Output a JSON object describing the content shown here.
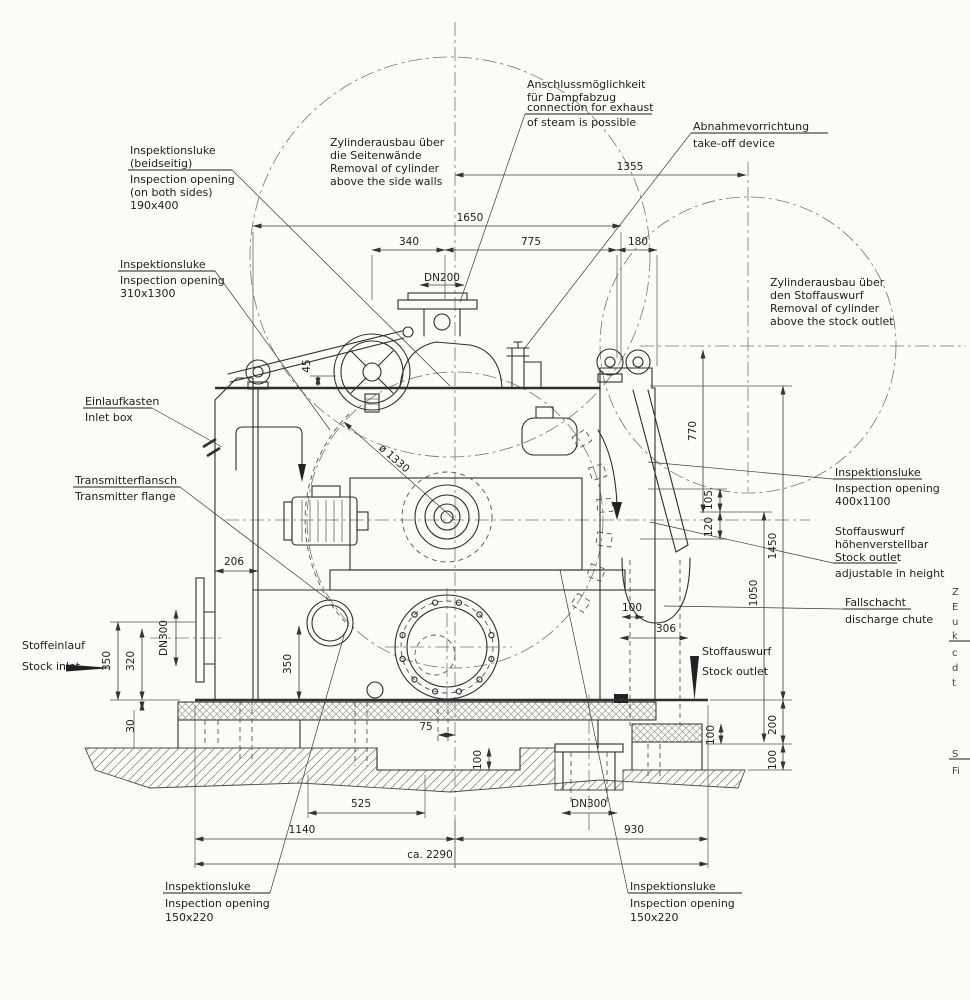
{
  "notes": {
    "steam": {
      "l1": "Anschlussmöglichkeit",
      "l2": "für Dampfabzug",
      "l3": "connection for exhaust",
      "l4": "of steam is possible"
    },
    "cyl_side": {
      "l1": "Zylinderausbau über",
      "l2": "die Seitenwände",
      "l3": "Removal of cylinder",
      "l4": "above the side walls"
    },
    "takeoff": {
      "l1": "Abnahmevorrichtung",
      "l2": "take-off device"
    },
    "insp190": {
      "l1": "Inspektionsluke",
      "l2": "(beidseitig)",
      "l3": "Inspection opening",
      "l4": "(on both sides)",
      "l5": "190x400"
    },
    "insp310": {
      "l1": "Inspektionsluke",
      "l2": "Inspection opening",
      "l3": "310x1300"
    },
    "cyl_outlet": {
      "l1": "Zylinderausbau über",
      "l2": "den Stoffauswurf",
      "l3": "Removal of cylinder",
      "l4": "above the stock outlet"
    },
    "inlet_box": {
      "l1": "Einlaufkasten",
      "l2": "Inlet box"
    },
    "transmitter": {
      "l1": "Transmitterflansch",
      "l2": "Transmitter flange"
    },
    "stock_inlet": {
      "l1": "Stoffeinlauf",
      "l2": "Stock inlet"
    },
    "insp400": {
      "l1": "Inspektionsluke",
      "l2": "Inspection opening",
      "l3": "400x1100"
    },
    "outlet_adj": {
      "l1": "Stoffauswurf",
      "l2": "höhenverstellbar",
      "l3": "Stock outlet",
      "l4": "adjustable in height"
    },
    "fallschacht": {
      "l1": "Fallschacht",
      "l2": "discharge chute"
    },
    "stock_outlet": {
      "l1": "Stoffauswurf",
      "l2": "Stock outlet"
    },
    "insp150_left": {
      "l1": "Inspektionsluke",
      "l2": "Inspection opening",
      "l3": "150x220"
    },
    "insp150_right": {
      "l1": "Inspektionsluke",
      "l2": "Inspection opening",
      "l3": "150x220"
    },
    "edge_fragments": {
      "l1": "Z",
      "l2": "E",
      "l3": "u",
      "l4": "k",
      "l5": "c",
      "l6": "d",
      "l7": "t",
      "l8": "S",
      "l9": "Fi"
    }
  },
  "dims": {
    "w1355": "1355",
    "w1650": "1650",
    "w340": "340",
    "w775": "775",
    "w180": "180",
    "dn200": "DN200",
    "h770": "770",
    "h1450": "1450",
    "h1050": "1050",
    "h105": "105",
    "h120": "120",
    "w100_chute": "100",
    "w306": "306",
    "w206": "206",
    "dn300_left": "DN300",
    "h350_left": "350",
    "h320": "320",
    "h30": "30",
    "h350_mid": "350",
    "w75": "75",
    "h100_pit": "100",
    "w525": "525",
    "w1140": "1140",
    "w930": "930",
    "w2290": "ca. 2290",
    "dn300_bottom": "DN300",
    "h200": "200",
    "h100_right": "100",
    "h100_step": "100",
    "h45": "45",
    "dia1330": "ø 1330"
  }
}
